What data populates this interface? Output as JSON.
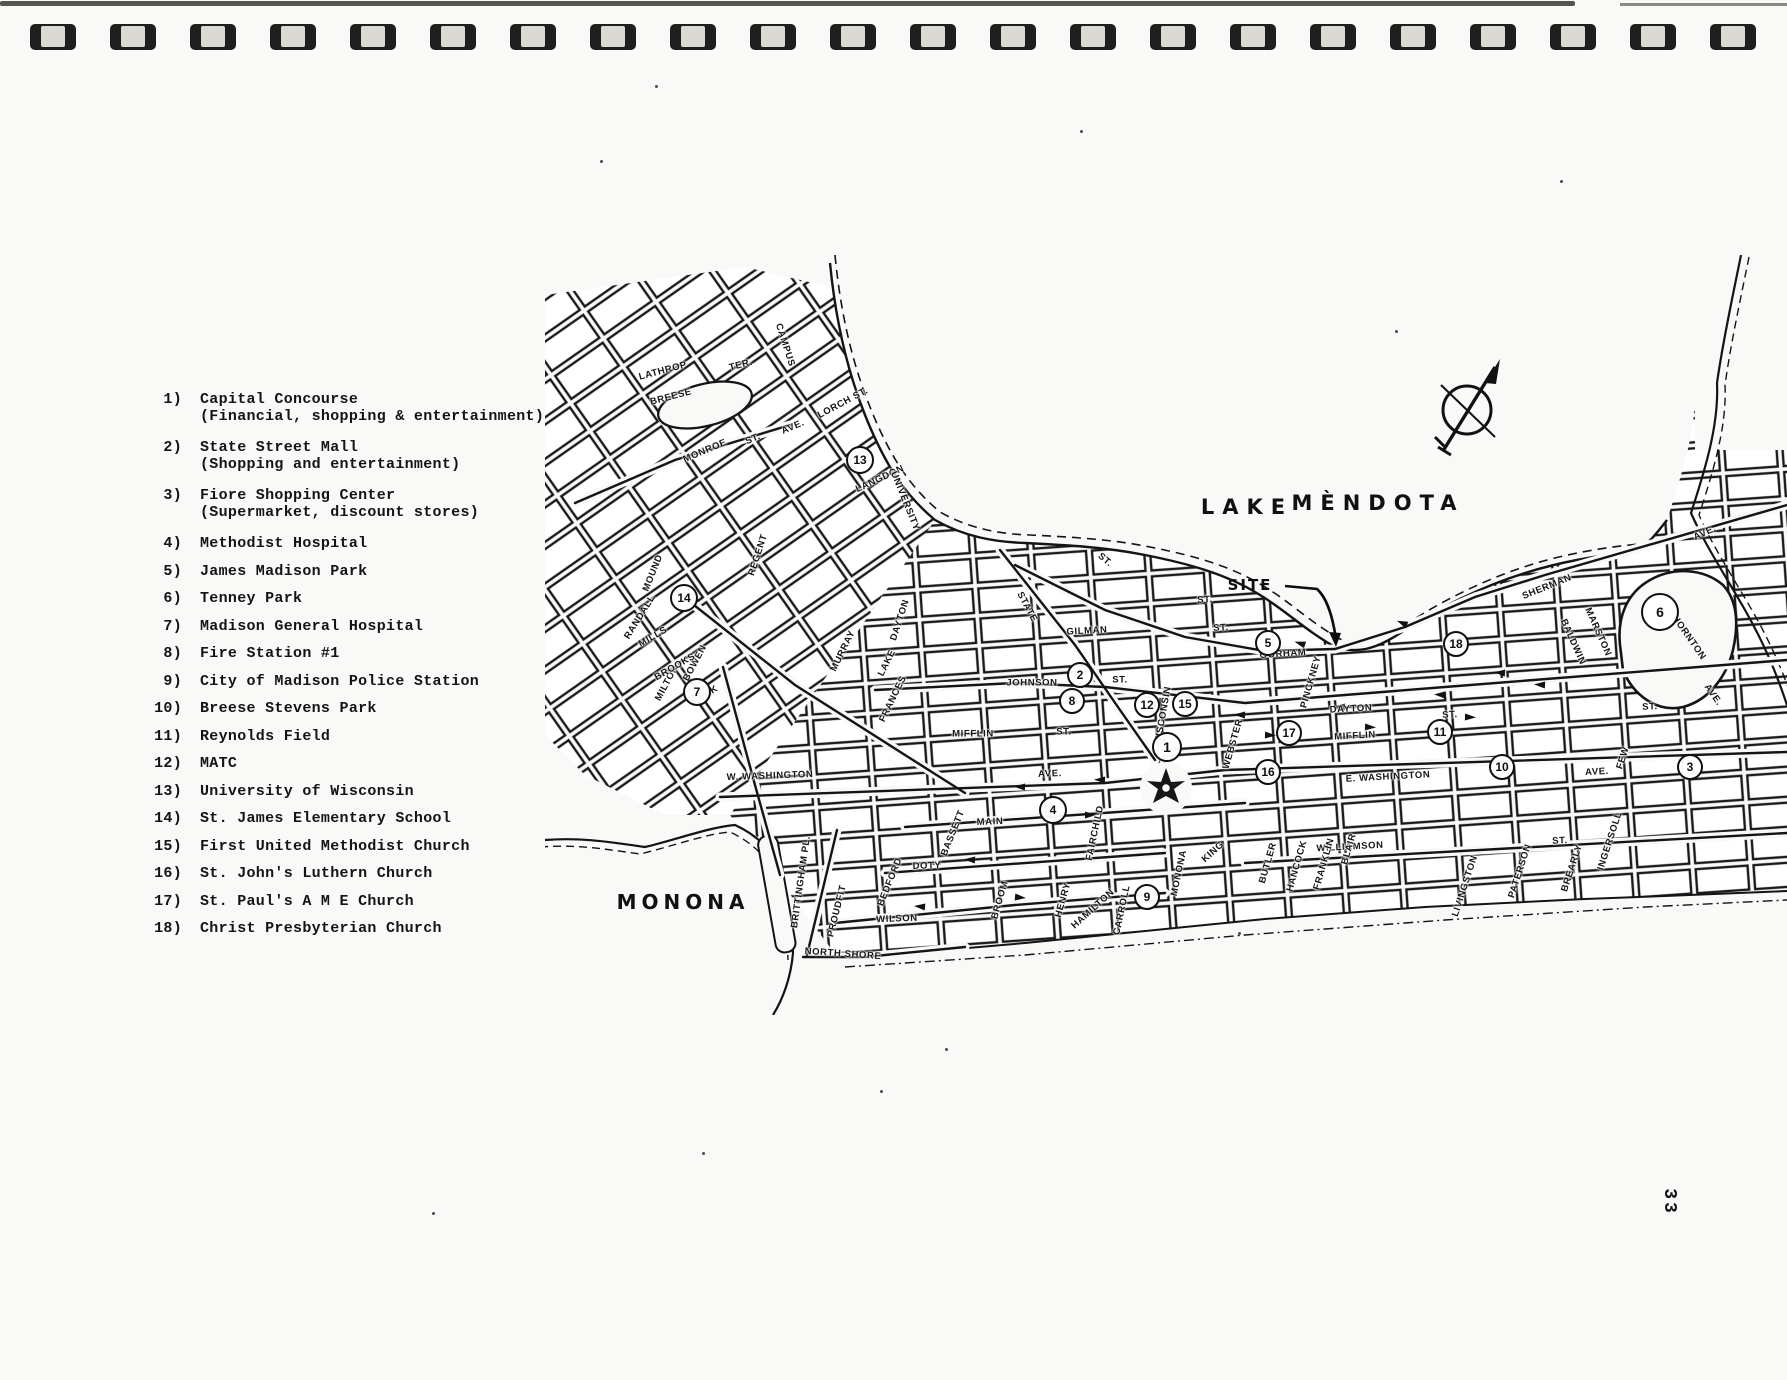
{
  "page": {
    "number": "33",
    "binding_hole_count": 22
  },
  "title": {
    "exhibit": "EXHIBIT 10",
    "line1": "IDENTIFICATION AND LOCATION OF MAJOR ACTIVITY",
    "line2": "AND RESIDENTIAL SUPPORT CENTERS"
  },
  "legend": {
    "items": [
      {
        "num": "1)",
        "name": "Capital Concourse",
        "desc": "(Financial, shopping & entertainment)"
      },
      {
        "num": "2)",
        "name": "State Street Mall",
        "desc": "(Shopping and entertainment)"
      },
      {
        "num": "3)",
        "name": "Fiore Shopping Center",
        "desc": "(Supermarket, discount stores)"
      },
      {
        "num": "4)",
        "name": "Methodist Hospital",
        "desc": ""
      },
      {
        "num": "5)",
        "name": "James Madison Park",
        "desc": ""
      },
      {
        "num": "6)",
        "name": "Tenney Park",
        "desc": ""
      },
      {
        "num": "7)",
        "name": "Madison General Hospital",
        "desc": ""
      },
      {
        "num": "8)",
        "name": "Fire Station #1",
        "desc": ""
      },
      {
        "num": "9)",
        "name": "City of Madison Police Station",
        "desc": ""
      },
      {
        "num": "10)",
        "name": "Breese Stevens Park",
        "desc": ""
      },
      {
        "num": "11)",
        "name": "Reynolds Field",
        "desc": ""
      },
      {
        "num": "12)",
        "name": "MATC",
        "desc": ""
      },
      {
        "num": "13)",
        "name": "University of Wisconsin",
        "desc": ""
      },
      {
        "num": "14)",
        "name": "St. James Elementary School",
        "desc": ""
      },
      {
        "num": "15)",
        "name": "First United Methodist Church",
        "desc": ""
      },
      {
        "num": "16)",
        "name": "St. John's Luthern Church",
        "desc": ""
      },
      {
        "num": "17)",
        "name": "St. Paul's A M E Church",
        "desc": ""
      },
      {
        "num": "18)",
        "name": "Christ Presbyterian Church",
        "desc": ""
      }
    ]
  },
  "map": {
    "site_label": "SITE",
    "lake_labels": [
      {
        "text": "LAKE",
        "x": 702,
        "y": 252,
        "style": "big"
      },
      {
        "text": "MÈNDOTA",
        "x": 833,
        "y": 248,
        "style": "big"
      },
      {
        "text": "MONONA",
        "x": 138,
        "y": 647,
        "style": "monona"
      }
    ],
    "markers": [
      {
        "n": "1",
        "x": 622,
        "y": 492,
        "r": 15
      },
      {
        "n": "2",
        "x": 535,
        "y": 420,
        "r": 13
      },
      {
        "n": "3",
        "x": 1145,
        "y": 512,
        "r": 13
      },
      {
        "n": "4",
        "x": 508,
        "y": 555,
        "r": 14
      },
      {
        "n": "5",
        "x": 723,
        "y": 388,
        "r": 13
      },
      {
        "n": "6",
        "x": 1115,
        "y": 357,
        "r": 19
      },
      {
        "n": "7",
        "x": 152,
        "y": 437,
        "r": 14
      },
      {
        "n": "8",
        "x": 527,
        "y": 446,
        "r": 13
      },
      {
        "n": "9",
        "x": 602,
        "y": 642,
        "r": 13
      },
      {
        "n": "10",
        "x": 957,
        "y": 512,
        "r": 13
      },
      {
        "n": "11",
        "x": 895,
        "y": 477,
        "r": 13
      },
      {
        "n": "12",
        "x": 602,
        "y": 450,
        "r": 13
      },
      {
        "n": "13",
        "x": 315,
        "y": 205,
        "r": 14
      },
      {
        "n": "14",
        "x": 139,
        "y": 343,
        "r": 14
      },
      {
        "n": "15",
        "x": 640,
        "y": 449,
        "r": 13
      },
      {
        "n": "16",
        "x": 723,
        "y": 517,
        "r": 13
      },
      {
        "n": "17",
        "x": 744,
        "y": 478,
        "r": 13
      },
      {
        "n": "18",
        "x": 911,
        "y": 389,
        "r": 13
      }
    ],
    "street_labels": [
      {
        "t": "GILMAN",
        "x": 542,
        "y": 376,
        "r": -3
      },
      {
        "t": "ST.",
        "x": 676,
        "y": 373,
        "r": -3
      },
      {
        "t": "GORHAM",
        "x": 738,
        "y": 399,
        "r": -4
      },
      {
        "t": "JOHNSON",
        "x": 487,
        "y": 428,
        "r": 0
      },
      {
        "t": "ST.",
        "x": 575,
        "y": 425,
        "r": 0
      },
      {
        "t": "DAYTON",
        "x": 806,
        "y": 454,
        "r": -3
      },
      {
        "t": "DAYTON",
        "x": 355,
        "y": 365,
        "r": -72
      },
      {
        "t": "MIFFLIN",
        "x": 428,
        "y": 479,
        "r": 0
      },
      {
        "t": "ST.",
        "x": 519,
        "y": 477,
        "r": 0
      },
      {
        "t": "MIFFLIN",
        "x": 810,
        "y": 481,
        "r": -3
      },
      {
        "t": "W. WASHINGTON",
        "x": 225,
        "y": 521,
        "r": -2
      },
      {
        "t": "AVE.",
        "x": 505,
        "y": 519,
        "r": -2
      },
      {
        "t": "E. WASHINGTON",
        "x": 843,
        "y": 522,
        "r": -3
      },
      {
        "t": "AVE.",
        "x": 1052,
        "y": 517,
        "r": -3
      },
      {
        "t": "MAIN",
        "x": 445,
        "y": 567,
        "r": -2
      },
      {
        "t": "DOTY",
        "x": 382,
        "y": 611,
        "r": -2
      },
      {
        "t": "WILSON",
        "x": 352,
        "y": 664,
        "r": -2
      },
      {
        "t": "NORTH SHORE",
        "x": 298,
        "y": 699,
        "r": 4
      },
      {
        "t": "WILLIAMSON",
        "x": 805,
        "y": 592,
        "r": -3
      },
      {
        "t": "ST.",
        "x": 1015,
        "y": 586,
        "r": -3
      },
      {
        "t": "SHERMAN",
        "x": 1002,
        "y": 332,
        "r": -22
      },
      {
        "t": "AVE.",
        "x": 1160,
        "y": 278,
        "r": -25
      },
      {
        "t": "MARSTON",
        "x": 1053,
        "y": 377,
        "r": 66
      },
      {
        "t": "BALDWIN",
        "x": 1028,
        "y": 387,
        "r": 66
      },
      {
        "t": "THORNTON",
        "x": 1142,
        "y": 380,
        "r": 55
      },
      {
        "t": "AVE.",
        "x": 1168,
        "y": 440,
        "r": 55
      },
      {
        "t": "MONROE",
        "x": 160,
        "y": 196,
        "r": -23
      },
      {
        "t": "ST.",
        "x": 208,
        "y": 184,
        "r": -23
      },
      {
        "t": "AVE.",
        "x": 248,
        "y": 172,
        "r": -23
      },
      {
        "t": "LORCH ST.",
        "x": 298,
        "y": 148,
        "r": -28
      },
      {
        "t": "CAMPUS",
        "x": 240,
        "y": 90,
        "r": 72
      },
      {
        "t": "LATHROP",
        "x": 118,
        "y": 116,
        "r": -15
      },
      {
        "t": "BREESE",
        "x": 126,
        "y": 142,
        "r": -15
      },
      {
        "t": "TER.",
        "x": 196,
        "y": 110,
        "r": -15
      },
      {
        "t": "RANDALL",
        "x": 95,
        "y": 362,
        "r": -58
      },
      {
        "t": "BOWEN",
        "x": 150,
        "y": 408,
        "r": -62
      },
      {
        "t": "MILTON",
        "x": 122,
        "y": 428,
        "r": -62
      },
      {
        "t": "MOUND",
        "x": 108,
        "y": 318,
        "r": -68
      },
      {
        "t": "MILLS",
        "x": 108,
        "y": 382,
        "r": -30
      },
      {
        "t": "BROOKS",
        "x": 130,
        "y": 412,
        "r": -30
      },
      {
        "t": "PARK",
        "x": 160,
        "y": 440,
        "r": -30
      },
      {
        "t": "REGENT",
        "x": 213,
        "y": 300,
        "r": -72
      },
      {
        "t": "MURRAY",
        "x": 298,
        "y": 396,
        "r": -64
      },
      {
        "t": "LAKE",
        "x": 342,
        "y": 408,
        "r": -64
      },
      {
        "t": "FRANCES",
        "x": 348,
        "y": 444,
        "r": -64
      },
      {
        "t": "STATE",
        "x": 482,
        "y": 352,
        "r": 62
      },
      {
        "t": "LANGDON",
        "x": 335,
        "y": 224,
        "r": -25
      },
      {
        "t": "UNIVERSITY",
        "x": 360,
        "y": 246,
        "r": 68
      },
      {
        "t": "BASSETT",
        "x": 408,
        "y": 578,
        "r": -68
      },
      {
        "t": "BEDFORD",
        "x": 345,
        "y": 627,
        "r": -68
      },
      {
        "t": "PROUDFIT",
        "x": 292,
        "y": 656,
        "r": -76
      },
      {
        "t": "BRITTINGHAM PL.",
        "x": 256,
        "y": 627,
        "r": -82
      },
      {
        "t": "FAIRCHILD",
        "x": 550,
        "y": 578,
        "r": -78
      },
      {
        "t": "CARROLL",
        "x": 577,
        "y": 655,
        "r": -78
      },
      {
        "t": "MONONA",
        "x": 634,
        "y": 618,
        "r": -78
      },
      {
        "t": "KING",
        "x": 668,
        "y": 597,
        "r": -42
      },
      {
        "t": "HAMILTON",
        "x": 548,
        "y": 654,
        "r": -42
      },
      {
        "t": "HENRY",
        "x": 518,
        "y": 645,
        "r": -74
      },
      {
        "t": "BROOM",
        "x": 455,
        "y": 645,
        "r": -74
      },
      {
        "t": "BUTLER",
        "x": 723,
        "y": 608,
        "r": -74
      },
      {
        "t": "HANCOCK",
        "x": 752,
        "y": 611,
        "r": -74
      },
      {
        "t": "FRANKLIN",
        "x": 779,
        "y": 609,
        "r": -74
      },
      {
        "t": "BLAIR",
        "x": 804,
        "y": 594,
        "r": -74
      },
      {
        "t": "WEBSTER",
        "x": 688,
        "y": 489,
        "r": -74
      },
      {
        "t": "PINCKNEY",
        "x": 766,
        "y": 427,
        "r": -74
      },
      {
        "t": "WISCONSIN",
        "x": 618,
        "y": 461,
        "r": -80
      },
      {
        "t": "LIVINGSTON",
        "x": 920,
        "y": 631,
        "r": -72
      },
      {
        "t": "PATERSON",
        "x": 975,
        "y": 616,
        "r": -72
      },
      {
        "t": "BREARLY",
        "x": 1027,
        "y": 613,
        "r": -72
      },
      {
        "t": "INGERSOLL",
        "x": 1065,
        "y": 586,
        "r": -72
      },
      {
        "t": "FEW",
        "x": 1078,
        "y": 503,
        "r": -72
      },
      {
        "t": "ST.",
        "x": 905,
        "y": 460,
        "r": -3
      },
      {
        "t": "ST.",
        "x": 1105,
        "y": 452,
        "r": -3
      },
      {
        "t": "ST.",
        "x": 660,
        "y": 345,
        "r": -3
      },
      {
        "t": "ST.",
        "x": 560,
        "y": 305,
        "r": 40
      }
    ]
  }
}
